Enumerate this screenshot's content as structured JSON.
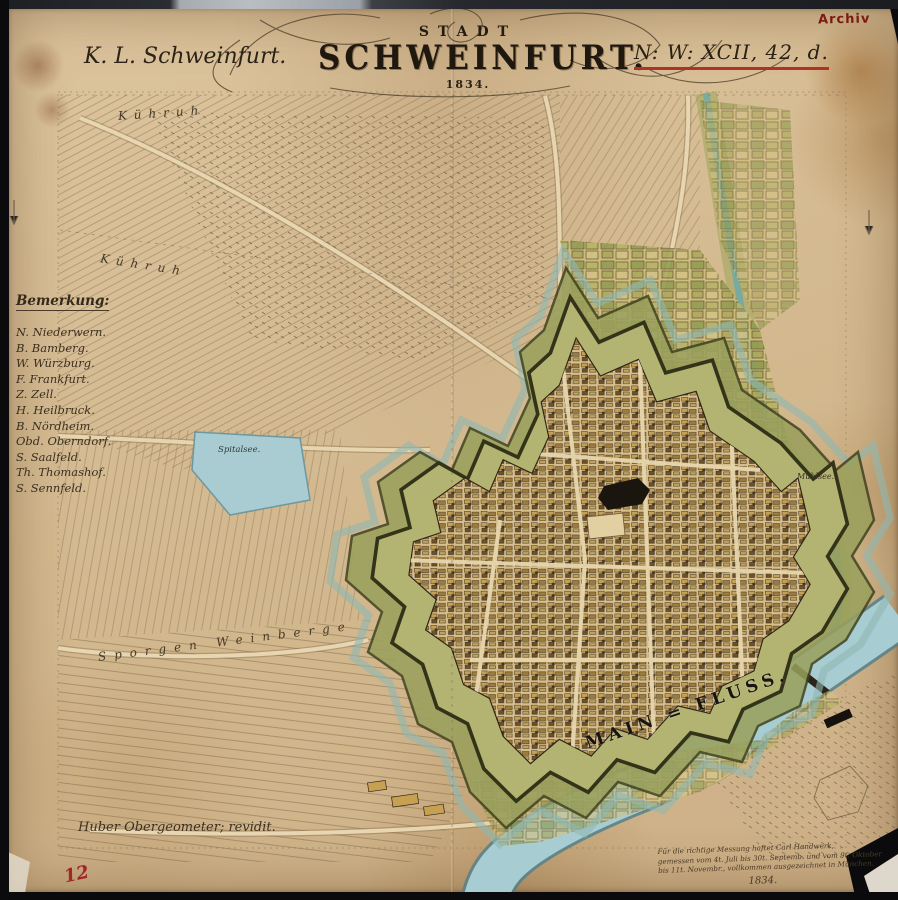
{
  "header": {
    "region_label": "K. L. Schweinfurt.",
    "title_small": "STADT",
    "title_main": "SCHWEINFURT.",
    "title_year": "1834.",
    "catalog_ref": "N: W: XCII, 42, d.",
    "archive_stamp": "Archiv"
  },
  "legend": {
    "heading": "Bemerkung:",
    "entries": [
      "N. Niederwern.",
      "B. Bamberg.",
      "W. Würzburg.",
      "F. Frankfurt.",
      "Z. Zell.",
      "H. Heilbruck.",
      "B. Nördheim.",
      "Obd. Oberndorf.",
      "S. Saalfeld.",
      "Th. Thomashof.",
      "S. Sennfeld."
    ]
  },
  "map_labels": {
    "pasture_upper": "Kühruh",
    "pasture_lower": "Kühruh",
    "pond": "Spitalsee.",
    "mill_pond": "Mühlsee.",
    "vineyards": "Sporgen Weinberge",
    "river": "MAIN = FLUSS."
  },
  "annotations": {
    "revision_note": "Huber Obergeometer; revidit.",
    "survey_note_lines": [
      "Für die richtige Messung haftet Carl Handwerk,",
      "gemessen vom 4t. Juli bis 30t. Septemb. und vom 9t. Oktober",
      "bis 11t. Novembr., vollkommen ausgezeichnet in München."
    ],
    "survey_note_year": "1834.",
    "sheet_number": "12"
  },
  "colors": {
    "accent-red": "#b03226",
    "stamp-red": "#7c1a12",
    "paper": "#d6bc93",
    "water": "#a7ccd2",
    "rampart": "#8a8f4b",
    "ink": "#342a1d"
  }
}
